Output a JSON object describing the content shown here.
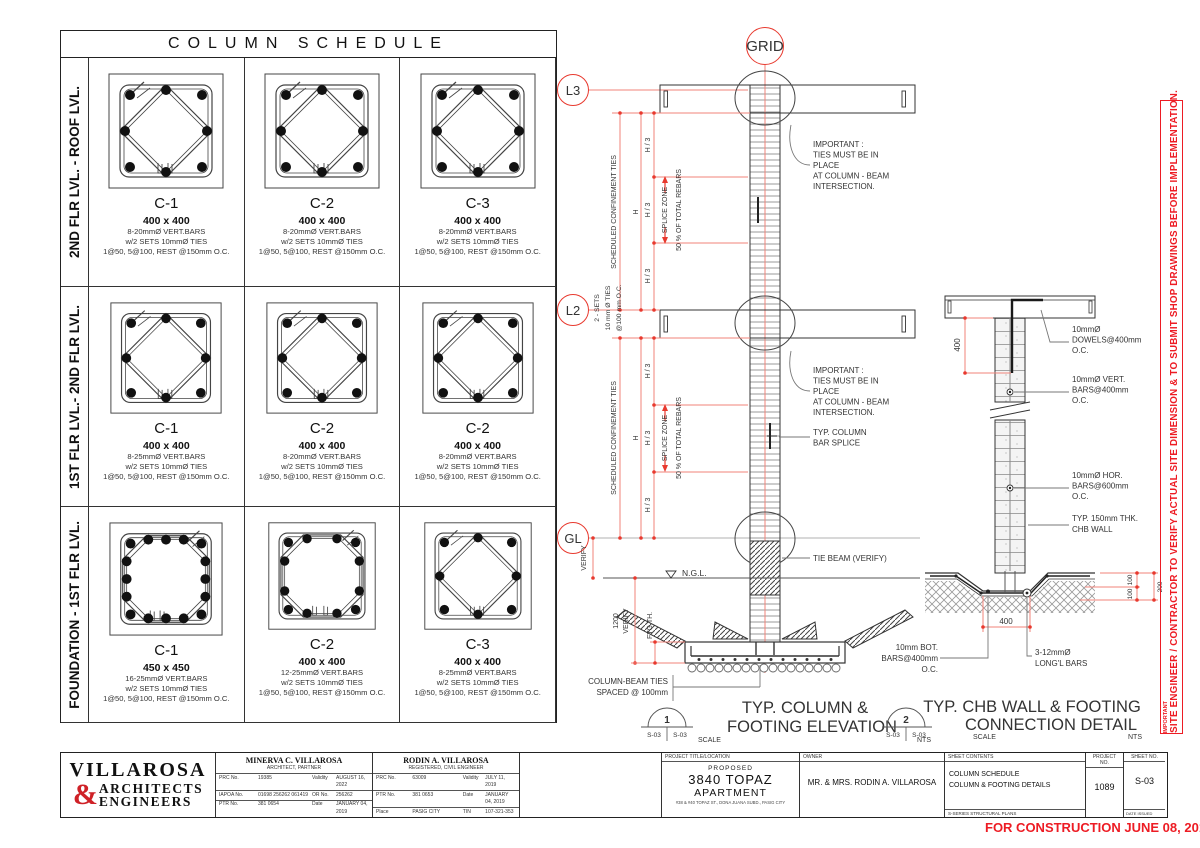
{
  "colors": {
    "accent_red": "#e8392e",
    "dim_red": "#f0837a",
    "stamp_red": "#ed1c24",
    "line_dark": "#333333"
  },
  "schedule": {
    "title": "COLUMN SCHEDULE",
    "rows": [
      {
        "level": "2ND FLR LVL. - ROOF LVL.",
        "cells": [
          {
            "name": "C-1",
            "size": "400 x 400",
            "spec1": "8-20mmØ VERT.BARS",
            "spec2": "w/2 SETS 10mmØ TIES",
            "spec3": "1@50, 5@100, REST @150mm O.C."
          },
          {
            "name": "C-2",
            "size": "400 x 400",
            "spec1": "8-20mmØ VERT.BARS",
            "spec2": "w/2 SETS 10mmØ TIES",
            "spec3": "1@50, 5@100, REST @150mm O.C."
          },
          {
            "name": "C-3",
            "size": "400 x 400",
            "spec1": "8-20mmØ VERT.BARS",
            "spec2": "w/2 SETS 10mmØ TIES",
            "spec3": "1@50, 5@100, REST @150mm O.C."
          }
        ]
      },
      {
        "level": "1ST FLR LVL.- 2ND FLR LVL.",
        "cells": [
          {
            "name": "C-1",
            "size": "400 x 400",
            "spec1": "8-25mmØ VERT.BARS",
            "spec2": "w/2 SETS 10mmØ TIES",
            "spec3": "1@50, 5@100, REST @150mm O.C."
          },
          {
            "name": "C-2",
            "size": "400 x 400",
            "spec1": "8-20mmØ VERT.BARS",
            "spec2": "w/2 SETS 10mmØ TIES",
            "spec3": "1@50, 5@100, REST @150mm O.C."
          },
          {
            "name": "C-2",
            "size": "400 x 400",
            "spec1": "8-20mmØ VERT.BARS",
            "spec2": "w/2 SETS 10mmØ TIES",
            "spec3": "1@50, 5@100, REST @150mm O.C."
          }
        ]
      },
      {
        "level": "FOUNDATION - 1ST FLR LVL.",
        "cells": [
          {
            "name": "C-1",
            "size": "450 x 450",
            "spec1": "16-25mmØ VERT.BARS",
            "spec2": "w/2 SETS 10mmØ TIES",
            "spec3": "1@50, 5@100, REST @150mm O.C."
          },
          {
            "name": "C-2",
            "size": "400 x 400",
            "spec1": "12-25mmØ VERT.BARS",
            "spec2": "w/2 SETS 10mmØ TIES",
            "spec3": "1@50, 5@100, REST @150mm O.C."
          },
          {
            "name": "C-3",
            "size": "400 x 400",
            "spec1": "8-25mmØ VERT.BARS",
            "spec2": "w/2 SETS 10mmØ TIES",
            "spec3": "1@50, 5@100, REST @150mm O.C."
          }
        ]
      }
    ]
  },
  "elevation": {
    "grid": "GRID",
    "l3": "L3",
    "l2": "L2",
    "gl": "GL",
    "confinement": "SCHEDULED CONFINEMENT TIES",
    "h": "H",
    "h3": "H / 3",
    "splice_zone": "SPLICE ZONE",
    "rebars": "50 % OF TOTAL REBARS",
    "sets1": "2 - SETS",
    "sets2": "10 mm Ø TIES",
    "sets3": "@100 mm O.C.",
    "note1": "IMPORTANT :",
    "note2": "TIES MUST BE IN",
    "note3": "PLACE",
    "note4": "AT COLUMN - BEAM",
    "note5": "INTERSECTION.",
    "splice1": "TYP. COLUMN",
    "splice2": "BAR SPLICE",
    "tie_beam": "TIE BEAM (VERIFY)",
    "ngl": "N.G.L.",
    "verify": "VERIFY",
    "v1200": "1200",
    "ftg": "FTG TH.",
    "cb1": "COLUMN-BEAM TIES",
    "cb2": "SPACED @ 100mm",
    "bubble_no": "1",
    "bubble_s1": "S-03",
    "bubble_s2": "S-03",
    "title1": "TYP. COLUMN &",
    "title2": "FOOTING ELEVATION",
    "scale": "SCALE",
    "nts": "NTS"
  },
  "chb": {
    "dim400": "400",
    "dim400b": "400",
    "dim100a": "100",
    "dim100b": "100",
    "dim200": "200",
    "dowels1": "10mmØ",
    "dowels2": "DOWELS@400mm",
    "dowels3": "O.C.",
    "vert1": "10mmØ VERT.",
    "vert2": "BARS@400mm",
    "vert3": "O.C.",
    "hor1": "10mmØ HOR.",
    "hor2": "BARS@600mm",
    "hor3": "O.C.",
    "chb1": "TYP. 150mm THK.",
    "chb2": "CHB  WALL",
    "bot1": "10mm BOT.",
    "bot2": "BARS@400mm",
    "bot3": "O.C.",
    "long1": "3-12mmØ",
    "long2": "LONG'L  BARS",
    "bubble_no": "2",
    "bubble_s1": "S-03",
    "bubble_s2": "S-03",
    "title1": "TYP. CHB WALL & FOOTING",
    "title2": "CONNECTION DETAIL",
    "scale": "SCALE",
    "nts": "NTS"
  },
  "note": {
    "important": "IMPORTANT",
    "text": "SITE ENGINEER / CONTRACTOR TO VERIFY ACTUAL SITE DIMENSION &  TO SUBMIT SHOP DRAWINGS BEFORE IMPLEMENTATION."
  },
  "titleblock": {
    "firm1": "VILLAROSA",
    "firm_amp": "&",
    "firm2": "ARCHITECTS",
    "firm3": "ENGINEERS",
    "arch": {
      "name": "MINERVA C. VILLAROSA",
      "role": "ARCHITECT,  PARTNER",
      "r1l": "PRC No.",
      "r1v": "19385",
      "r1l2": "Validity",
      "r1v2": "AUGUST 16, 2022",
      "r2l": "IAPOA No.",
      "r2v": "01698 256262 061419",
      "r2l2": "OR No.",
      "r2v2": "256262",
      "r3l": "PTR No.",
      "r3v": "381 0654",
      "r3l2": "Date",
      "r3v2": "JANUARY 04, 2019",
      "r4l": "Place",
      "r4v": "MANDALUYONG CITY",
      "r4l2": "TIN",
      "r4v2": "102-804-911"
    },
    "engr": {
      "name": "RODIN A. VILLAROSA",
      "role": "REGISTERED, CIVIL ENGINEER",
      "r1l": "PRC No.",
      "r1v": "63009",
      "r1l2": "Validity",
      "r1v2": "JULY 11, 2019",
      "r2l": "PTR No.",
      "r2v": "381 0653",
      "r2l2": "Date",
      "r2v2": "JANUARY 04, 2019",
      "r3l": "Place",
      "r3v": "PASIG CITY",
      "r3l2": "TIN",
      "r3v2": "107-321-353"
    },
    "project": {
      "header": "PROJECT TITLE/LOCATION",
      "l1": "PROPOSED",
      "l2": "3840 TOPAZ",
      "l3": "APARTMENT",
      "l4": "#38 & #40 TOPAZ ST., DONA JUANA SUBD., PASIG CITY"
    },
    "owner": {
      "header": "OWNER",
      "name": "MR. & MRS. RODIN A. VILLAROSA"
    },
    "contents": {
      "header": "SHEET CONTENTS",
      "l1": "COLUMN SCHEDULE",
      "l2": "COLUMN & FOOTING DETAILS",
      "footer": "S-SERIES STRUCTURAL PLANS"
    },
    "projno": {
      "header": "PROJECT NO.",
      "value": "1089"
    },
    "sheetno": {
      "header": "SHEET NO.",
      "value": "S-03",
      "footer": "DATE ISSUED"
    },
    "stamp": "FOR CONSTRUCTION  JUNE 08, 2019"
  }
}
